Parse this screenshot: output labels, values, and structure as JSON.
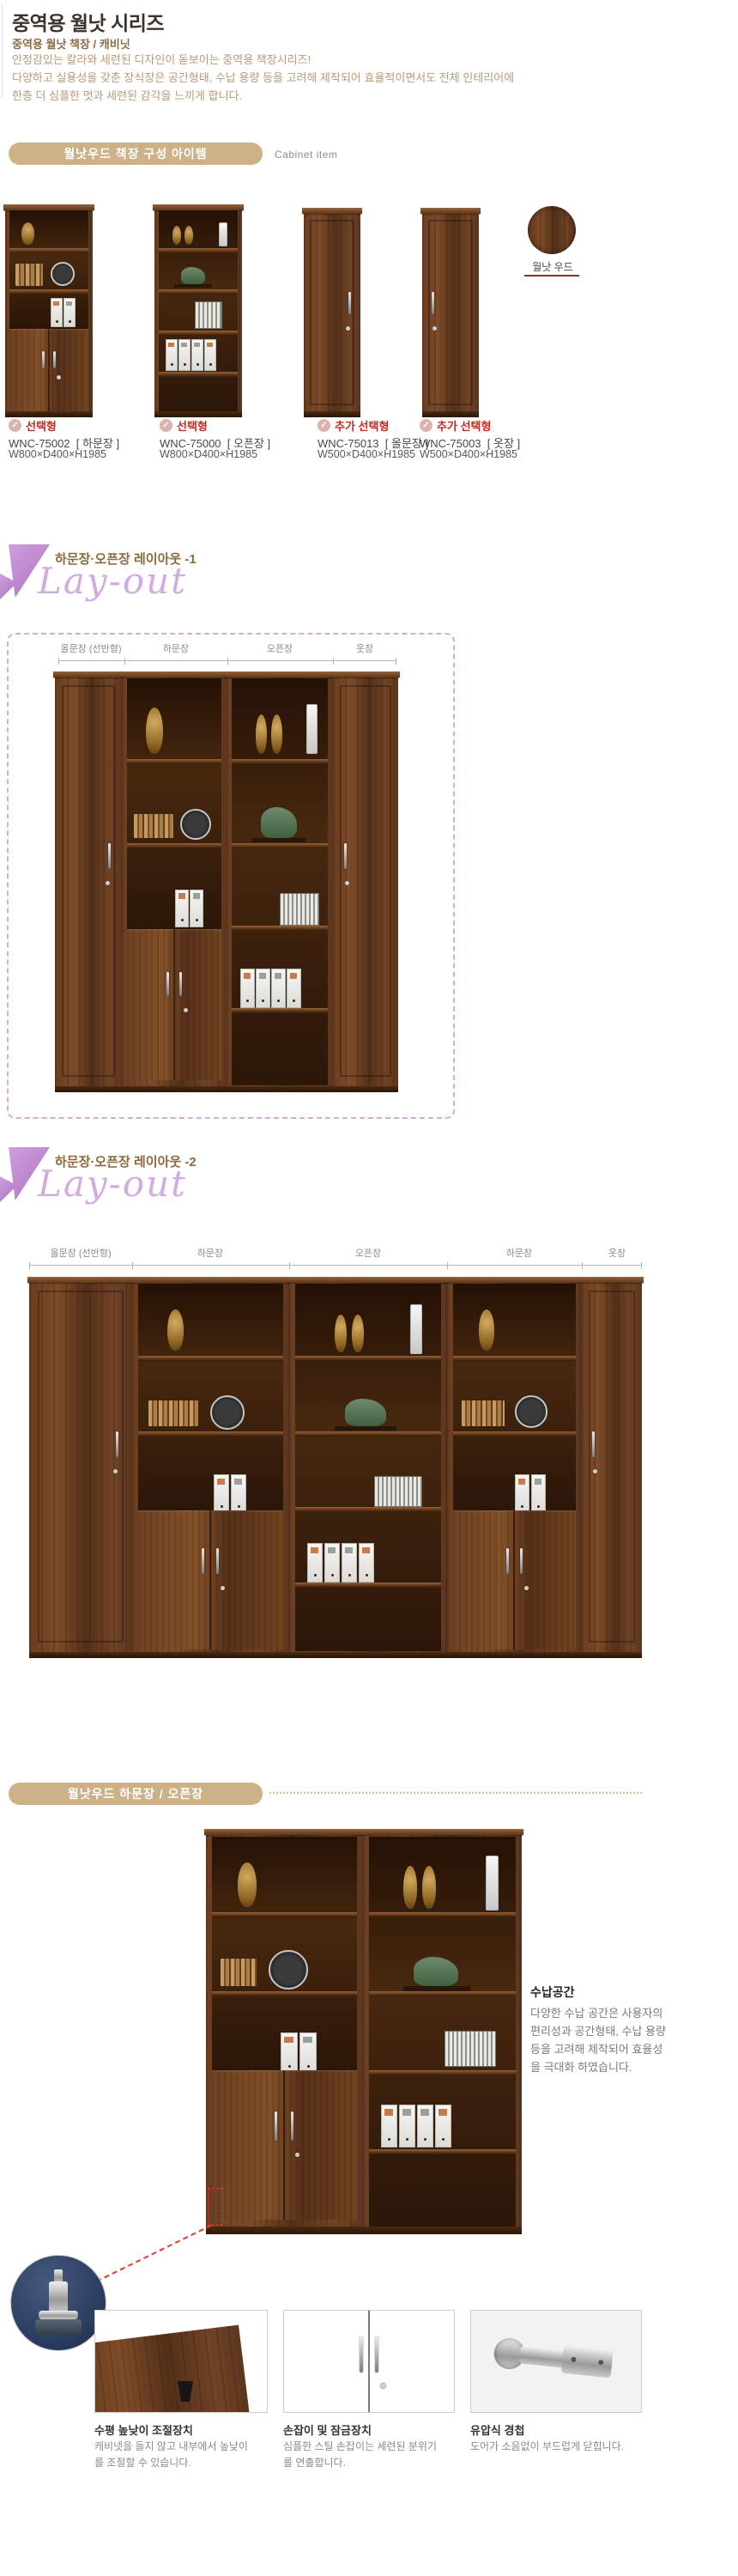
{
  "header": {
    "title": "중역용 월낫 시리즈",
    "subtitle": "중역용 월낫 책장 / 캐비닛",
    "description": [
      "안정감있는 칼라와 세련된 디자인이 돋보이는 중역용 책장시리즈!",
      "다양하고 실용성을 갖춘 장식장은 공간형태, 수납 용량 등을 고려해 제작되어 효율적이면서도 전체 인테리어에",
      "한층 더 심플한 멋과 세련된 감각을 느끼게 합니다."
    ]
  },
  "cabinet_items": {
    "bar_label": "월낫우드 책장 구성 아이템",
    "side_label": "Cabinet item",
    "swatch_label": "월낫 우드",
    "products": [
      {
        "badge": "선택형",
        "code": "WNC-75002",
        "name": "[ 하문장 ]",
        "dims": "W800×D400×H1985"
      },
      {
        "badge": "선택형",
        "code": "WNC-75000",
        "name": "[ 오픈장 ]",
        "dims": "W800×D400×H1985"
      },
      {
        "badge": "추가 선택형",
        "code": "WNC-75013",
        "name": "[ 올문장 ]",
        "dims": "W500×D400×H1985"
      },
      {
        "badge": "추가 선택형",
        "code": "WNC-75003",
        "name": "[ 옷장 ]",
        "dims": "W500×D400×H1985"
      }
    ]
  },
  "layout1": {
    "title": "하문장·오픈장 레이아웃 -1",
    "script": "Lay-out",
    "labels": [
      "올문장 (선반형)",
      "하문장",
      "오픈장",
      "옷장"
    ]
  },
  "layout2": {
    "title": "하문장·오픈장 레이아웃 -2",
    "script": "Lay-out",
    "labels": [
      "올문장 (선반형)",
      "하문장",
      "오픈장",
      "하문장",
      "옷장"
    ]
  },
  "detail": {
    "bar_label": "월낫우드 하문장 / 오픈장",
    "storage_title": "수납공간",
    "storage_lines": [
      "다양한 수납 공간은 사용자의",
      "편리성과 공간형태, 수납 용량",
      "등을 고려해 제작되어 효율성",
      "을 극대화 하였습니다."
    ],
    "features": [
      {
        "title": "수평 높낮이 조절장치",
        "line1": "캐비넷을 들지 않고 내부에서 높낮이",
        "line2": "를 조절할 수 있습니다."
      },
      {
        "title": "손잡이 및 잠금장치",
        "line1": "심플한 스틸 손잡이는 세련된 분위기",
        "line2": "를 연출합니다."
      },
      {
        "title": "유압식 경첩",
        "line1": "도어가 소음없이 부드럽게 닫힙니다.",
        "line2": ""
      }
    ]
  },
  "icons": {
    "check": "✓"
  },
  "colors": {
    "bar_bg": "#cdb187",
    "badge_red": "#c32b20",
    "script_purple": "#d2abe0",
    "border_purple": "#d7abdf",
    "wood_dark": "#5b3419",
    "red_dashed": "#e23b2e"
  }
}
